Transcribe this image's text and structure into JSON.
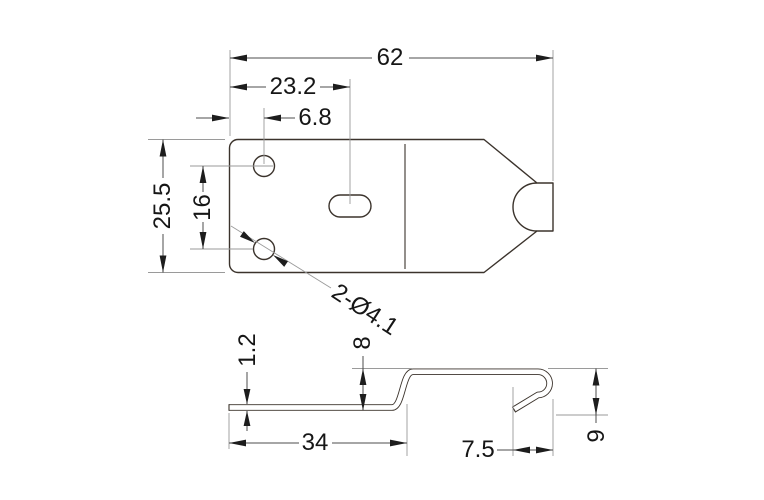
{
  "colors": {
    "background": "#ffffff",
    "outline": "#3b332c",
    "dimension_line": "#4c4c4c",
    "extension_line": "#9a9a9a",
    "text": "#161616",
    "arrowhead": "#1d1d1d"
  },
  "top_view": {
    "dimensions": {
      "overall_width": "62",
      "slot_center_from_left": "23.2",
      "hole_center_from_left": "6.8",
      "overall_height": "25.5",
      "hole_vertical_spacing": "16",
      "hole_diameter_callout": "2-Ø4.1"
    }
  },
  "side_view": {
    "dimensions": {
      "material_thickness": "1.2",
      "step_height": "8",
      "base_flange_length": "34",
      "hook_width": "7.5",
      "hook_height": "9"
    }
  }
}
